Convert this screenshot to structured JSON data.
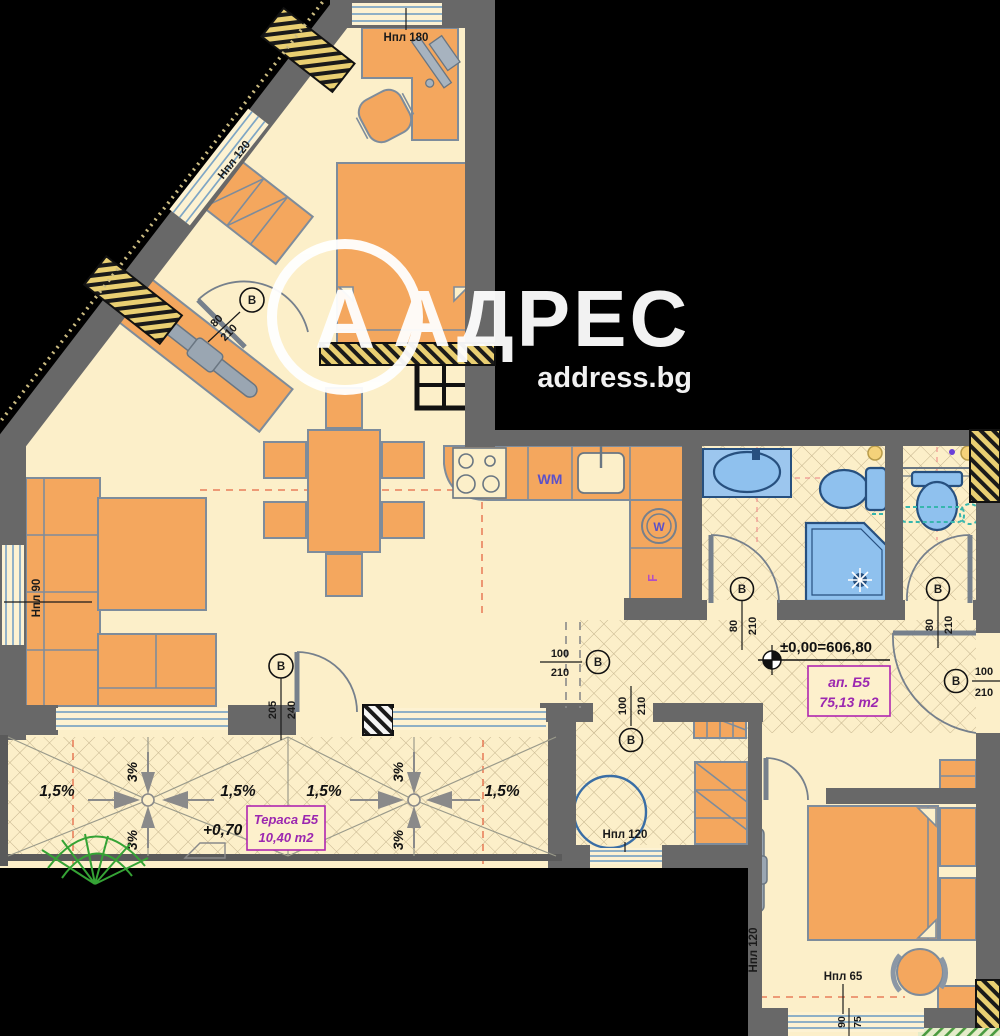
{
  "watermark": {
    "logo_letter": "А",
    "brand": "АДРЕС",
    "site": "address.bg"
  },
  "apartment": {
    "name": "ап. Б5",
    "area": "75,13 m2",
    "level_mark": "±0,00=606,80"
  },
  "terrace": {
    "name": "Тераса Б5",
    "area": "10,40 m2",
    "level": "+0,70",
    "slope_main": "1,5%",
    "slope_cross": "3%"
  },
  "labels": {
    "window_sill_180": "Нпл 180",
    "window_sill_120": "Нпл 120",
    "window_sill_90": "Нпл 90",
    "window_sill_65": "Нпл 65",
    "window_dim_num": "90",
    "window_dim_den": "75"
  },
  "doors": {
    "letter": "В",
    "bedroom1": {
      "w": "80",
      "h": "210"
    },
    "bathroom": {
      "w": "80",
      "h": "210"
    },
    "wc": {
      "w": "80",
      "h": "210"
    },
    "terrace_door": {
      "w": "205",
      "h": "240"
    },
    "hall_opening": {
      "w": "100",
      "h": "210"
    },
    "storage": {
      "w": "100",
      "h": "210"
    },
    "entry": {
      "w": "100",
      "h": "210"
    }
  },
  "appliances": {
    "washer": "WM",
    "boiler": "W",
    "fridge": "F"
  },
  "colors": {
    "background": "#000000",
    "floor": "#fcefc9",
    "walls": "#686868",
    "furniture": "#f4a75e",
    "fixtures": "#8fc1ee",
    "hatch_yellow": "#e9cf72",
    "accent_purple": "#9c27b0",
    "appliance_blue": "#5b51c8",
    "axis_red": "#e0502e",
    "plant_green": "#35a335",
    "watermark_white": "#ffffff"
  }
}
